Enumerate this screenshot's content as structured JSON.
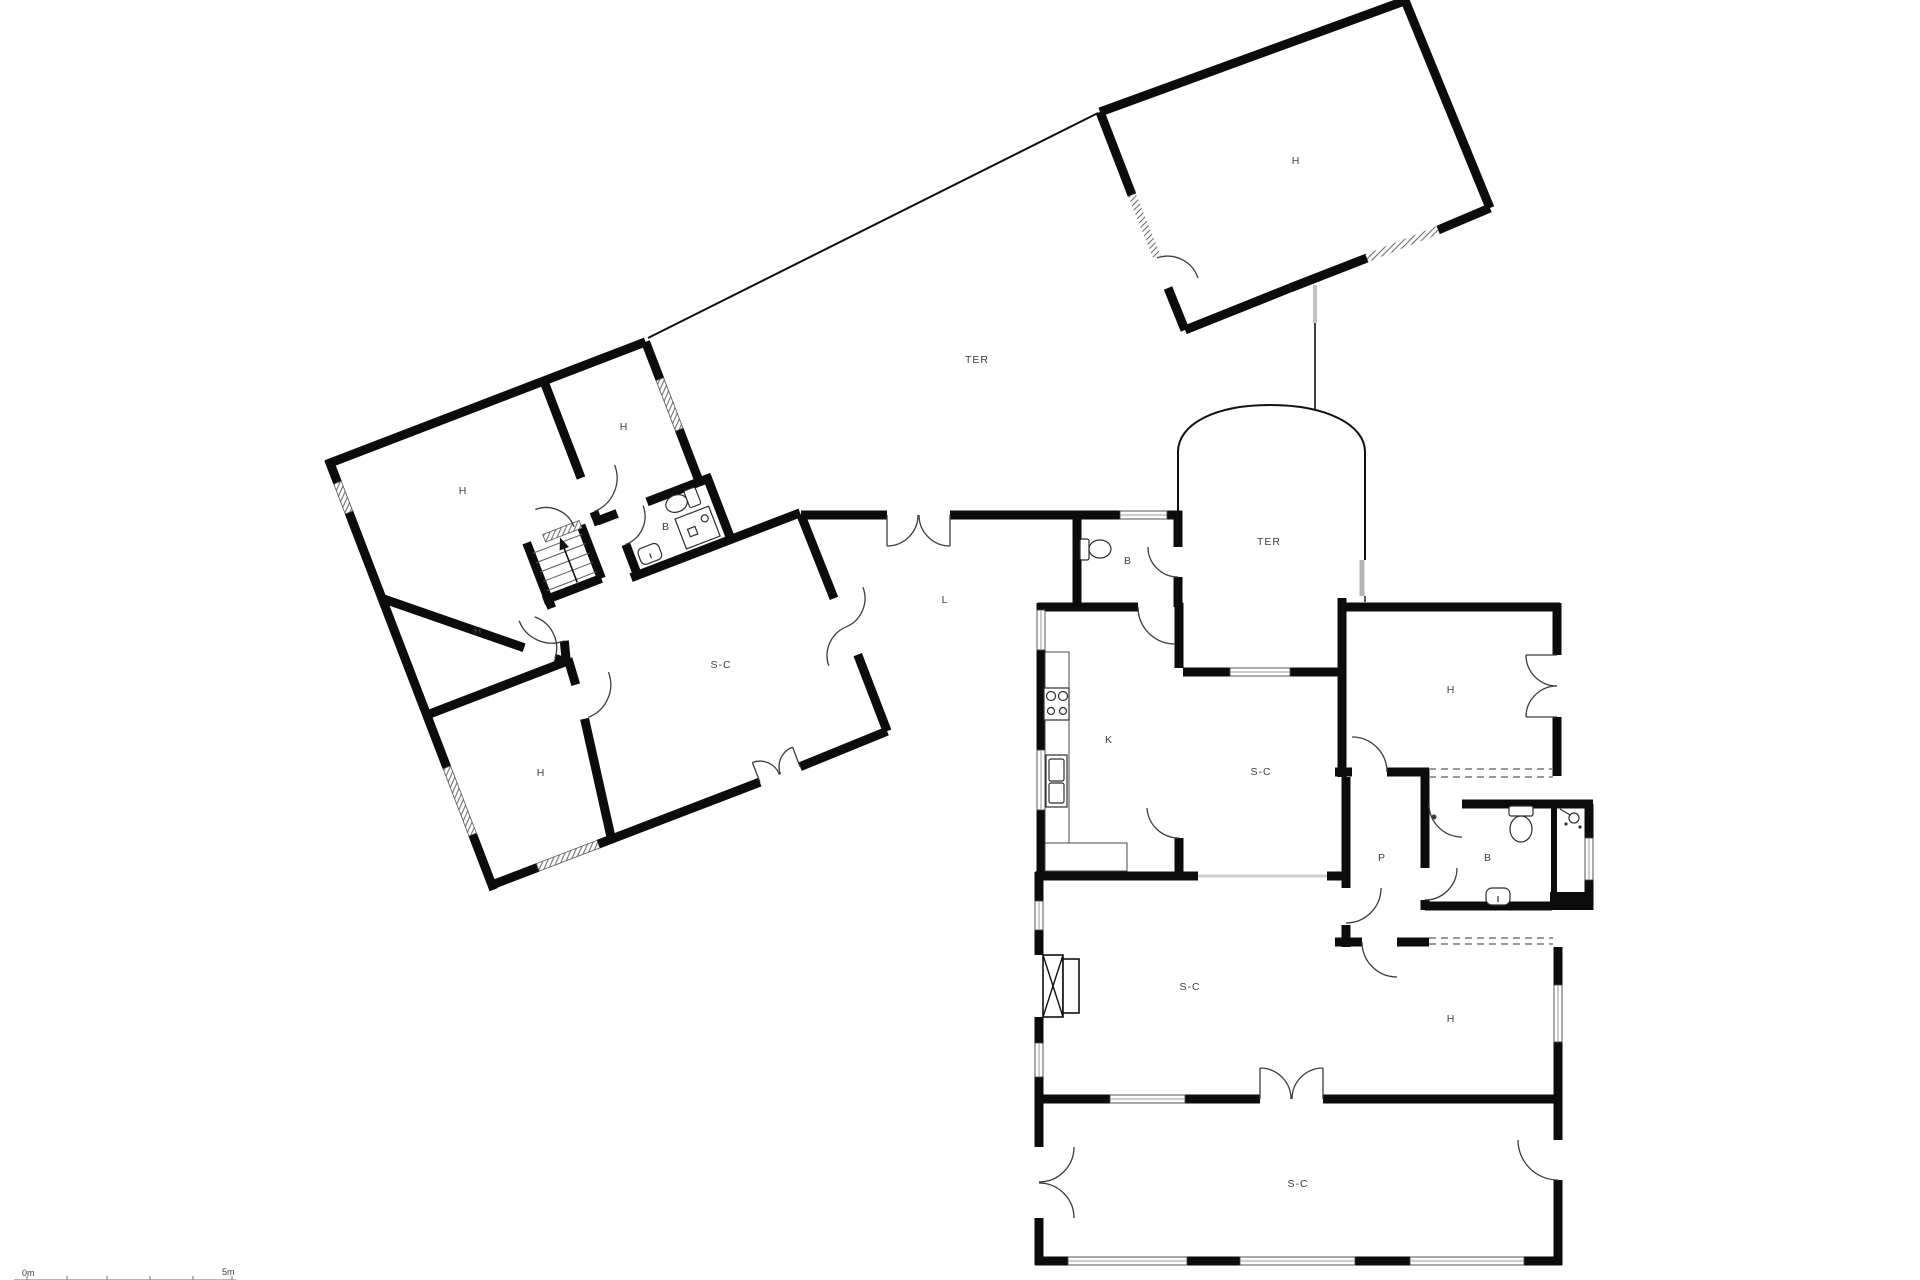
{
  "title": "floor-plan",
  "colors": {
    "wall": "#0c0c0c",
    "door_arc": "#3c3c3c",
    "label": "#3d3d3d",
    "window_hatch": "#777777",
    "terrace_line": "#111111"
  },
  "rooms": [
    {
      "id": "h-left-big",
      "label": "H",
      "x": 463,
      "y": 494
    },
    {
      "id": "h-left-small",
      "label": "H",
      "x": 624,
      "y": 430
    },
    {
      "id": "b-left",
      "label": "B",
      "x": 666,
      "y": 530
    },
    {
      "id": "h-left-mid",
      "label": "H",
      "x": 478,
      "y": 634
    },
    {
      "id": "h-left-bottom",
      "label": "H",
      "x": 541,
      "y": 776
    },
    {
      "id": "sc-left",
      "label": "S-C",
      "x": 721,
      "y": 668
    },
    {
      "id": "l-room",
      "label": "L",
      "x": 945,
      "y": 603
    },
    {
      "id": "ter-top",
      "label": "TER",
      "x": 977,
      "y": 363
    },
    {
      "id": "h-top-right",
      "label": "H",
      "x": 1296,
      "y": 164
    },
    {
      "id": "ter-arch",
      "label": "TER",
      "x": 1269,
      "y": 545
    },
    {
      "id": "b-small",
      "label": "B",
      "x": 1128,
      "y": 564
    },
    {
      "id": "kitchen",
      "label": "K",
      "x": 1109,
      "y": 743
    },
    {
      "id": "sc-upper",
      "label": "S-C",
      "x": 1261,
      "y": 775
    },
    {
      "id": "h-right-top",
      "label": "H",
      "x": 1451,
      "y": 693
    },
    {
      "id": "p-hall",
      "label": "P",
      "x": 1382,
      "y": 861
    },
    {
      "id": "b-right",
      "label": "B",
      "x": 1488,
      "y": 861
    },
    {
      "id": "sc-mid",
      "label": "S-C",
      "x": 1190,
      "y": 990
    },
    {
      "id": "h-right-bottom",
      "label": "H",
      "x": 1451,
      "y": 1022
    },
    {
      "id": "sc-porch",
      "label": "S-C",
      "x": 1298,
      "y": 1187
    }
  ],
  "scale_bar": {
    "start_label": "0m",
    "end_label": "5m"
  }
}
